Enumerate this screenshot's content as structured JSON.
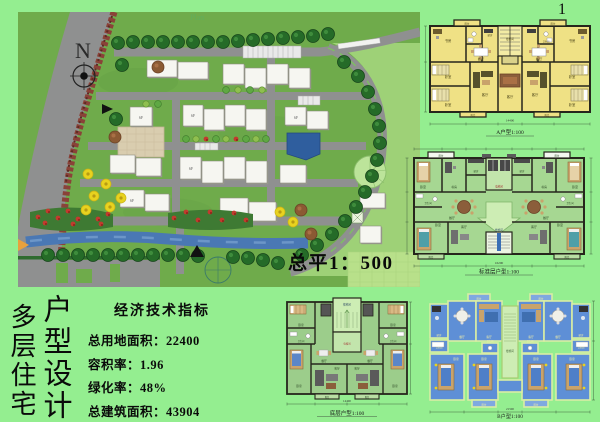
{
  "page": {
    "number": "1"
  },
  "titles": {
    "col1": "多层住宅",
    "col2": "户型设计"
  },
  "indicators": {
    "title": "经济技术指标",
    "items": [
      "总用地面积：22400",
      "容积率：1.96",
      "绿化率：48%",
      "总建筑面积：43904"
    ]
  },
  "site_plan": {
    "scale_label": "总平1：500",
    "north_label": "N",
    "building_label": "6F",
    "watermark": "Plan"
  },
  "rooms": {
    "bedroom": "卧室",
    "study": "书房",
    "living": "客厅",
    "dining": "餐厅",
    "balcony": "阳台",
    "kitchen": "厨房",
    "bath": "卫生间",
    "stair": "楼梯间",
    "elevator": "电梯间"
  },
  "plans": {
    "plan1": {
      "caption": "A户型1:100",
      "total_dim": "14400"
    },
    "plan2": {
      "caption": "标准层户型1:100",
      "total_dim": "16200"
    },
    "plan3": {
      "caption": "底层户型1:100",
      "total_dim": "14400"
    },
    "plan4": {
      "caption": "B户型1:100",
      "total_dim": "21500"
    }
  },
  "colors": {
    "board_bg": "#94EE90",
    "grass": "#6FAB4B",
    "road": "#8F9090",
    "river": "#4A78B4",
    "pond": "#2F5E9E",
    "plan_yellow": "#EFE185",
    "plan_green": "#A6D792",
    "plan_blue": "#5E8FD6",
    "wall": "#26261C",
    "flower_red": "#C23B2E",
    "flower_yellow": "#E8D21F",
    "tree": "#256B28"
  }
}
